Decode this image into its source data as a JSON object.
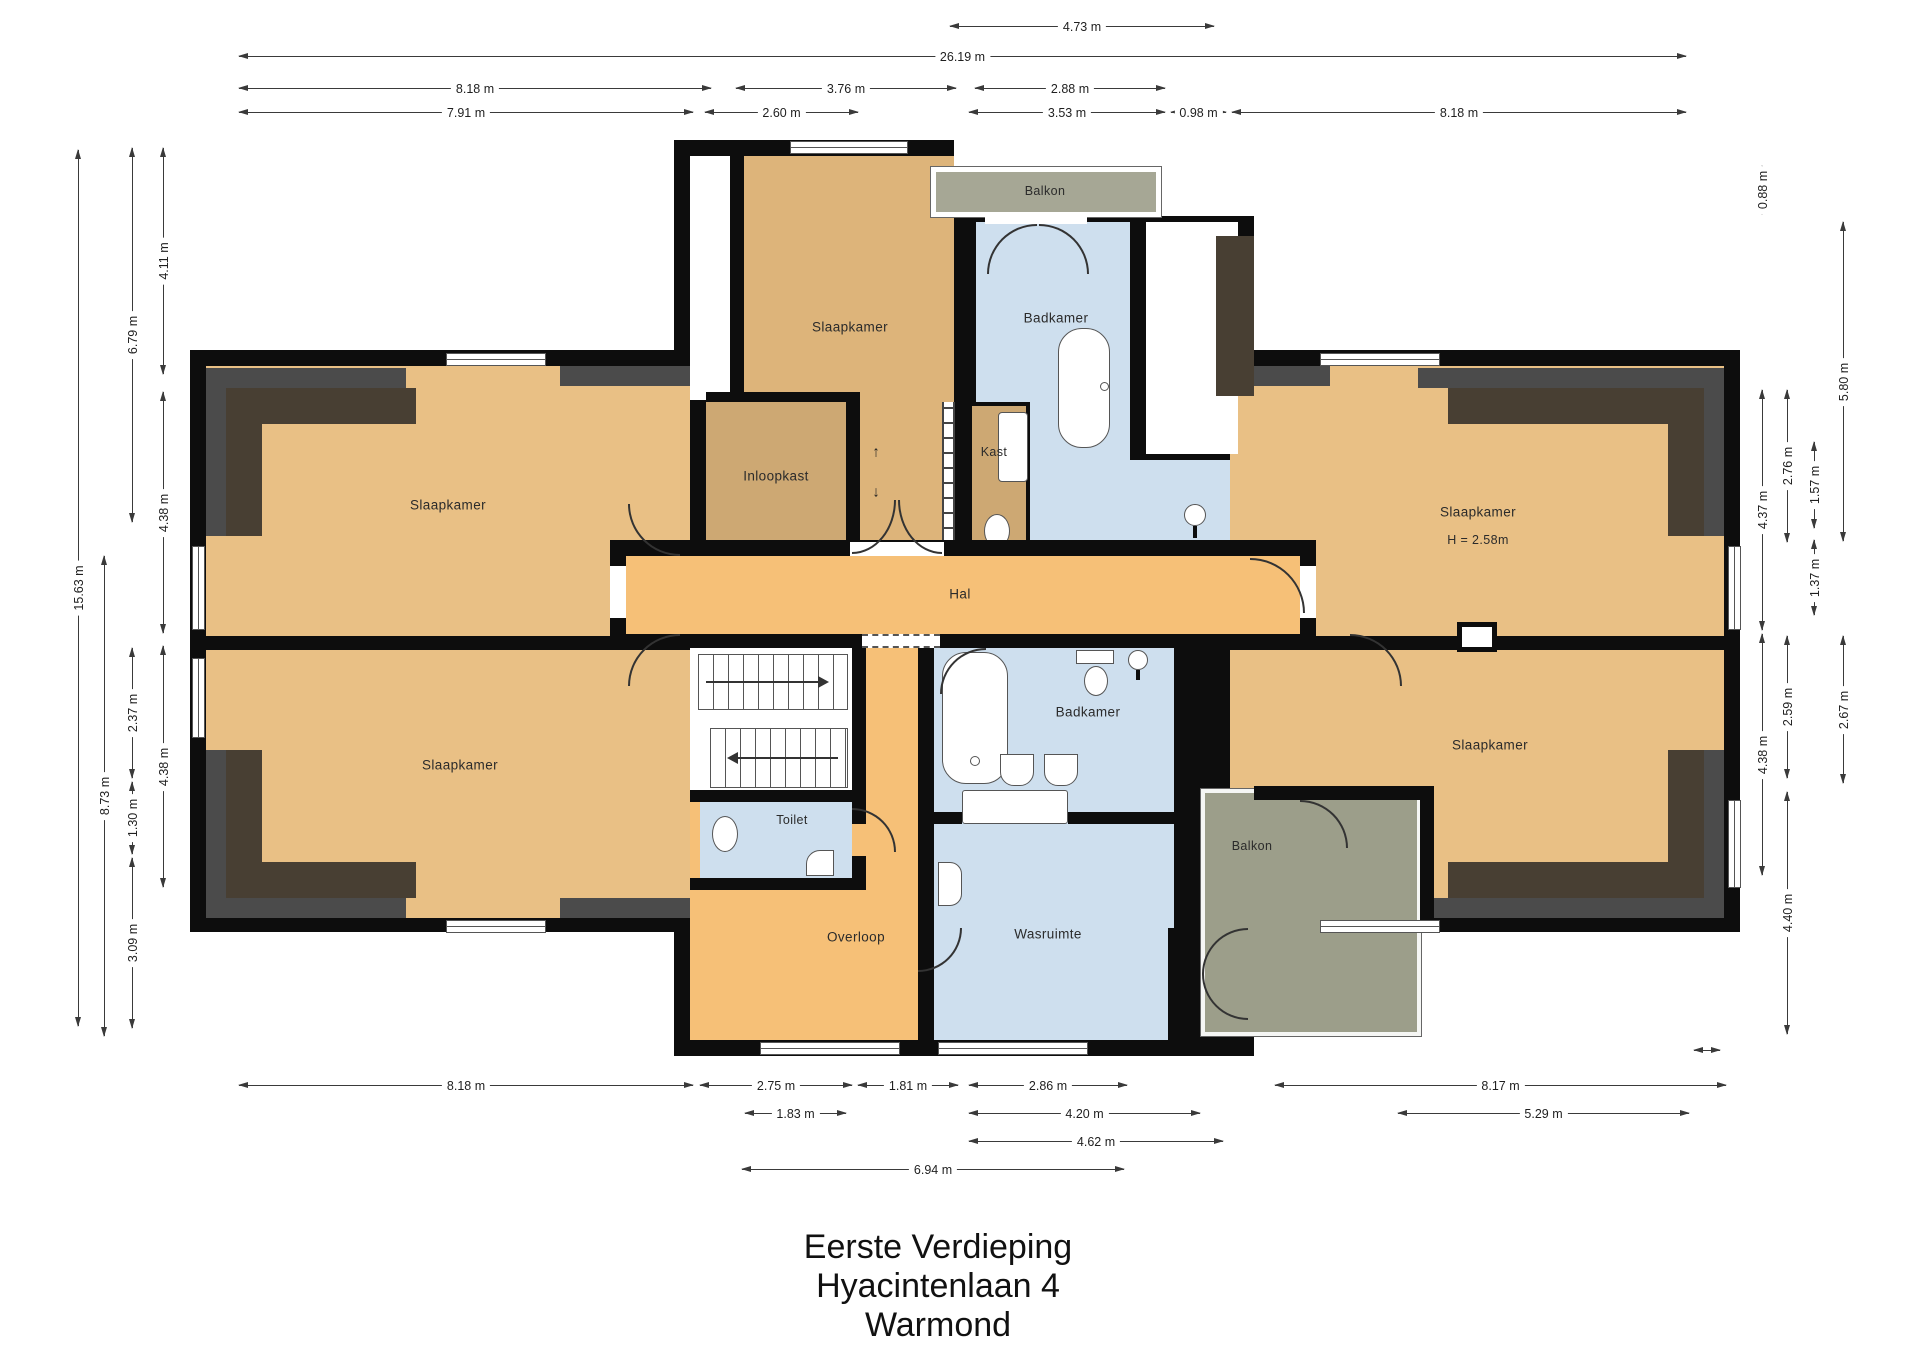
{
  "title": {
    "lines": [
      "Eerste Verdieping",
      "Hyacintenlaan 4",
      "Warmond"
    ]
  },
  "rooms": {
    "slaapkamer_left_top": "Slaapkamer",
    "slaapkamer_left_bottom": "Slaapkamer",
    "slaapkamer_center": "Slaapkamer",
    "badkamer_top": "Badkamer",
    "balkon_top": "Balkon",
    "inloopkast": "Inloopkast",
    "kast": "Kast",
    "hal": "Hal",
    "toilet": "Toilet",
    "overloop": "Overloop",
    "badkamer_bottom": "Badkamer",
    "wasruimte": "Wasruimte",
    "balkon_bottom": "Balkon",
    "slaapkamer_right_top": "Slaapkamer",
    "slaapkamer_right_top_height": "H = 2.58m",
    "slaapkamer_right_bottom": "Slaapkamer"
  },
  "icons": {
    "stair_up_arrow": "↑",
    "stair_down_arrow": "↓"
  },
  "colors": {
    "room": "#E9C085",
    "center_room": "#DDB47A",
    "closet": "#CDA873",
    "hall": "#F6C077",
    "bathroom": "#CEDFEE",
    "balcony_top": "#A6A795",
    "balcony_bottom": "#9C9E8A",
    "wall": "#0D0D0D",
    "roof_dark": "#4B4B4B",
    "roof_brown": "#483F33"
  },
  "dimensions": [
    {
      "o": "h",
      "x": 950,
      "y": 26,
      "l": 264,
      "label": "4.73 m"
    },
    {
      "o": "h",
      "x": 239,
      "y": 56,
      "l": 1447,
      "label": "26.19 m"
    },
    {
      "o": "h",
      "x": 239,
      "y": 88,
      "l": 472,
      "label": "8.18 m"
    },
    {
      "o": "h",
      "x": 736,
      "y": 88,
      "l": 220,
      "label": "3.76 m"
    },
    {
      "o": "h",
      "x": 975,
      "y": 88,
      "l": 190,
      "label": "2.88 m"
    },
    {
      "o": "h",
      "x": 239,
      "y": 112,
      "l": 454,
      "label": "7.91 m"
    },
    {
      "o": "h",
      "x": 705,
      "y": 112,
      "l": 153,
      "label": "2.60 m"
    },
    {
      "o": "h",
      "x": 969,
      "y": 112,
      "l": 196,
      "label": "3.53 m"
    },
    {
      "o": "h",
      "x": 1171,
      "y": 112,
      "l": 55,
      "label": "0.98 m"
    },
    {
      "o": "h",
      "x": 1232,
      "y": 112,
      "l": 454,
      "label": "8.18 m"
    },
    {
      "o": "h",
      "x": 239,
      "y": 1085,
      "l": 454,
      "label": "8.18 m"
    },
    {
      "o": "h",
      "x": 700,
      "y": 1085,
      "l": 152,
      "label": "2.75 m"
    },
    {
      "o": "h",
      "x": 858,
      "y": 1085,
      "l": 100,
      "label": "1.81 m"
    },
    {
      "o": "h",
      "x": 969,
      "y": 1085,
      "l": 158,
      "label": "2.86 m"
    },
    {
      "o": "h",
      "x": 1275,
      "y": 1085,
      "l": 451,
      "label": "8.17 m"
    },
    {
      "o": "h",
      "x": 745,
      "y": 1113,
      "l": 101,
      "label": "1.83 m"
    },
    {
      "o": "h",
      "x": 969,
      "y": 1113,
      "l": 231,
      "label": "4.20 m"
    },
    {
      "o": "h",
      "x": 1398,
      "y": 1113,
      "l": 291,
      "label": "5.29 m"
    },
    {
      "o": "h",
      "x": 969,
      "y": 1141,
      "l": 254,
      "label": "4.62 m"
    },
    {
      "o": "h",
      "x": 742,
      "y": 1169,
      "l": 382,
      "label": "6.94 m"
    },
    {
      "o": "h",
      "x": 1694,
      "y": 1050,
      "l": 26,
      "label": ""
    },
    {
      "o": "v",
      "x": 78,
      "y": 150,
      "l": 876,
      "label": "15.63 m"
    },
    {
      "o": "v",
      "x": 104,
      "y": 556,
      "l": 480,
      "label": "8.73 m"
    },
    {
      "o": "v",
      "x": 132,
      "y": 148,
      "l": 374,
      "label": "6.79 m"
    },
    {
      "o": "v",
      "x": 132,
      "y": 648,
      "l": 130,
      "label": "2.37 m"
    },
    {
      "o": "v",
      "x": 132,
      "y": 782,
      "l": 72,
      "label": "1.30 m"
    },
    {
      "o": "v",
      "x": 132,
      "y": 858,
      "l": 170,
      "label": "3.09 m"
    },
    {
      "o": "v",
      "x": 163,
      "y": 148,
      "l": 226,
      "label": "4.11 m"
    },
    {
      "o": "v",
      "x": 163,
      "y": 392,
      "l": 241,
      "label": "4.38 m"
    },
    {
      "o": "v",
      "x": 163,
      "y": 646,
      "l": 241,
      "label": "4.38 m"
    },
    {
      "o": "v",
      "x": 1762,
      "y": 166,
      "l": 48,
      "label": "0.88 m"
    },
    {
      "o": "v",
      "x": 1843,
      "y": 222,
      "l": 319,
      "label": "5.80 m"
    },
    {
      "o": "v",
      "x": 1762,
      "y": 390,
      "l": 240,
      "label": "4.37 m"
    },
    {
      "o": "v",
      "x": 1787,
      "y": 390,
      "l": 152,
      "label": "2.76 m"
    },
    {
      "o": "v",
      "x": 1814,
      "y": 442,
      "l": 86,
      "label": "1.57 m"
    },
    {
      "o": "v",
      "x": 1814,
      "y": 540,
      "l": 75,
      "label": "1.37 m"
    },
    {
      "o": "v",
      "x": 1762,
      "y": 634,
      "l": 241,
      "label": "4.38 m"
    },
    {
      "o": "v",
      "x": 1787,
      "y": 636,
      "l": 142,
      "label": "2.59 m"
    },
    {
      "o": "v",
      "x": 1843,
      "y": 636,
      "l": 147,
      "label": "2.67 m"
    },
    {
      "o": "v",
      "x": 1787,
      "y": 792,
      "l": 242,
      "label": "4.40 m"
    }
  ]
}
